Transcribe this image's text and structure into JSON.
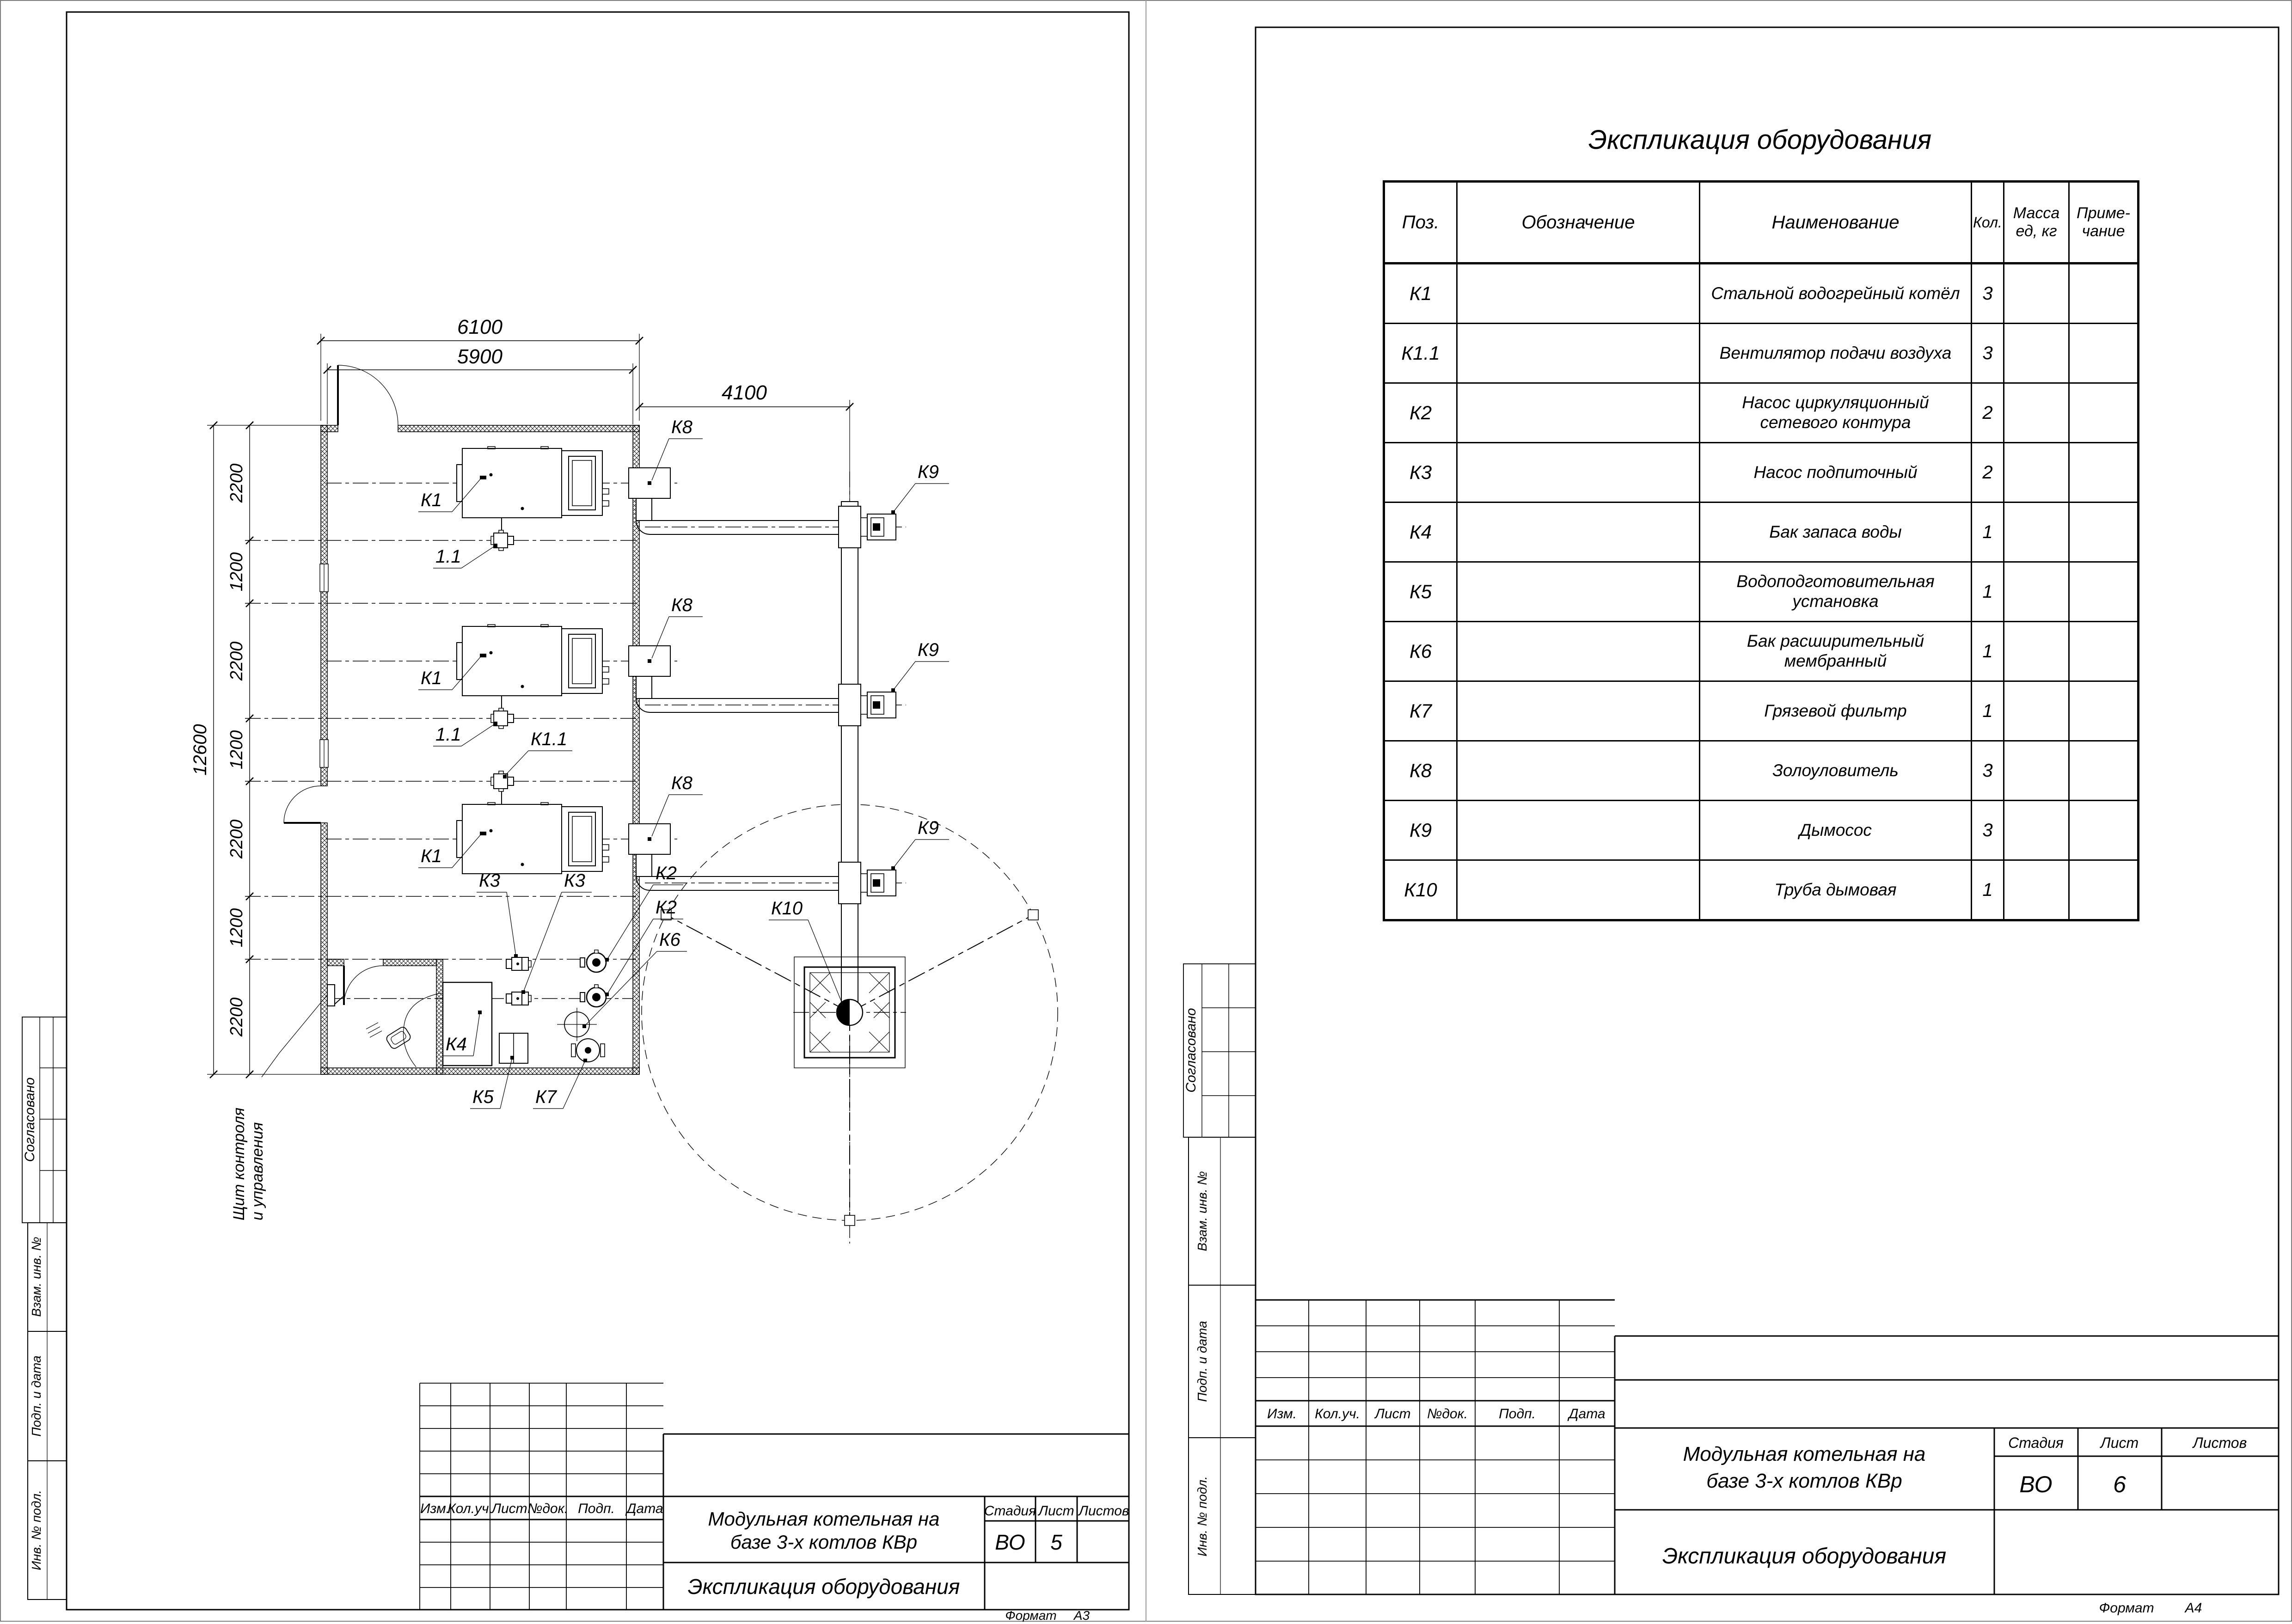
{
  "plan": {
    "dims": {
      "outer_width": "6100",
      "inner_width": "5900",
      "total_height": "12600",
      "flue_offset": "4100",
      "chain": [
        "2200",
        "1200",
        "2200",
        "1200",
        "2200",
        "1200",
        "2200"
      ]
    },
    "tags": {
      "k1": "К1",
      "fan": "1.1",
      "k11": "К1.1",
      "k2": "К2",
      "k3": "К3",
      "k4": "К4",
      "k5": "К5",
      "k6": "К6",
      "k7": "К7",
      "k8": "К8",
      "k9": "К9",
      "k10": "К10"
    },
    "note": {
      "line1": "Щит контроля",
      "line2": "и управления"
    }
  },
  "table": {
    "title": "Экспликация оборудования",
    "headers": {
      "pos": "Поз.",
      "designation": "Обозначение",
      "name": "Наименование",
      "qty": "Кол.",
      "mass1": "Масса",
      "mass2": "ед, кг",
      "note1": "Приме-",
      "note2": "чание"
    },
    "rows": [
      {
        "pos": "К1",
        "designation": "",
        "name": "Стальной водогрейный котёл",
        "name2": "",
        "qty": "3",
        "mass": "",
        "note": ""
      },
      {
        "pos": "К1.1",
        "designation": "",
        "name": "Вентилятор подачи воздуха",
        "name2": "",
        "qty": "3",
        "mass": "",
        "note": ""
      },
      {
        "pos": "К2",
        "designation": "",
        "name": "Насос циркуляционный",
        "name2": "сетевого контура",
        "qty": "2",
        "mass": "",
        "note": ""
      },
      {
        "pos": "К3",
        "designation": "",
        "name": "Насос подпиточный",
        "name2": "",
        "qty": "2",
        "mass": "",
        "note": ""
      },
      {
        "pos": "К4",
        "designation": "",
        "name": "Бак запаса воды",
        "name2": "",
        "qty": "1",
        "mass": "",
        "note": ""
      },
      {
        "pos": "К5",
        "designation": "",
        "name": "Водоподготовительная установка",
        "name2": "",
        "qty": "1",
        "mass": "",
        "note": ""
      },
      {
        "pos": "К6",
        "designation": "",
        "name": "Бак расширительный мембранный",
        "name2": "",
        "qty": "1",
        "mass": "",
        "note": ""
      },
      {
        "pos": "К7",
        "designation": "",
        "name": "Грязевой фильтр",
        "name2": "",
        "qty": "1",
        "mass": "",
        "note": ""
      },
      {
        "pos": "К8",
        "designation": "",
        "name": "Золоуловитель",
        "name2": "",
        "qty": "3",
        "mass": "",
        "note": ""
      },
      {
        "pos": "К9",
        "designation": "",
        "name": "Дымосос",
        "name2": "",
        "qty": "3",
        "mass": "",
        "note": ""
      },
      {
        "pos": "К10",
        "designation": "",
        "name": "Труба дымовая",
        "name2": "",
        "qty": "1",
        "mass": "",
        "note": ""
      }
    ]
  },
  "titleblock": {
    "project1": "Модульная котельная на",
    "project2": "базе 3-х котлов КВр",
    "doc_title": "Экспликация оборудования",
    "stage_label": "Стадия",
    "sheet_label": "Лист",
    "sheets_label": "Листов",
    "stage": "ВО",
    "left_sheet_no": "5",
    "right_sheet_no": "6",
    "rev": {
      "izm": "Изм.",
      "koluch": "Кол.уч.",
      "list": "Лист",
      "ndok": "№док.",
      "podp": "Подп.",
      "data": "Дата"
    },
    "format_label": "Формат",
    "left_format": "А3",
    "right_format": "А4"
  },
  "sidebar": {
    "soglasovano": "Согласовано",
    "vzam": "Взам. инв. №",
    "podp": "Подп. и дата",
    "inv": "Инв. № подл."
  }
}
